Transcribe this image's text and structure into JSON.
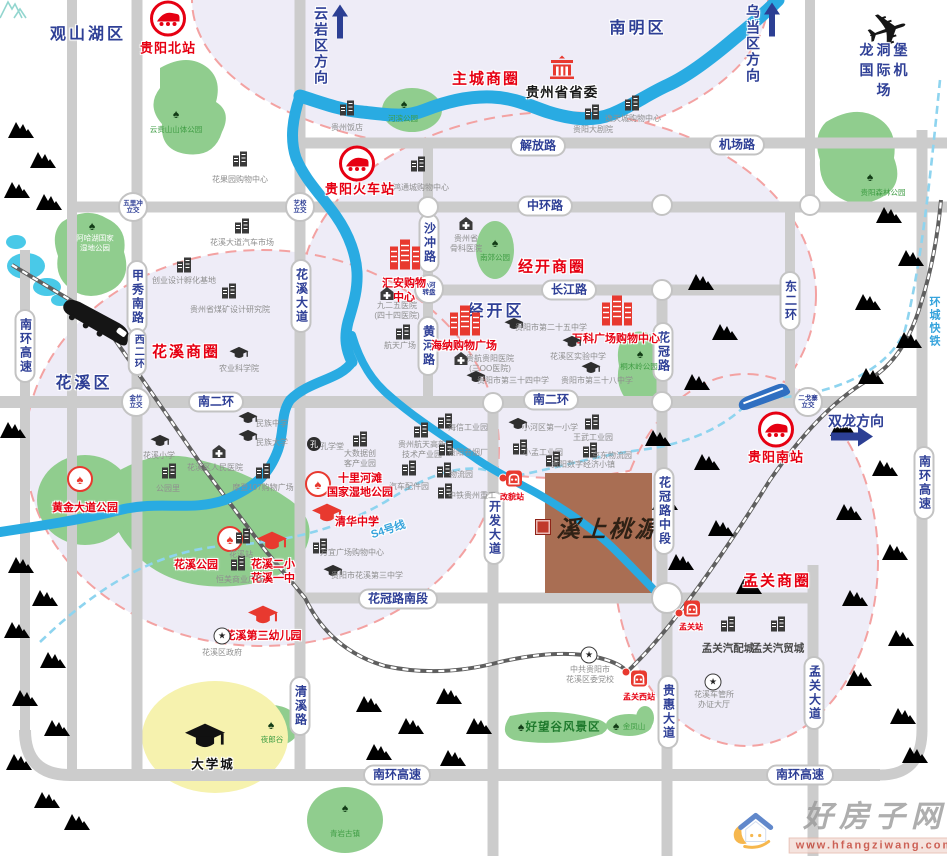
{
  "property": {
    "name": "溪上桃源"
  },
  "watermark": {
    "site": "好房子网",
    "url": "www.hfangziwang.com"
  },
  "districts": [
    {
      "t": "观山湖区",
      "x": 88,
      "y": 32
    },
    {
      "t": "南明区",
      "x": 638,
      "y": 26
    },
    {
      "t": "花溪区",
      "x": 84,
      "y": 381
    },
    {
      "t": "经开区",
      "x": 496,
      "y": 309
    }
  ],
  "directions": [
    {
      "t": "云岩区方向",
      "x": 321,
      "y": 46,
      "ax": 340,
      "ay": 24,
      "arrow": "up"
    },
    {
      "t": "乌当区方向",
      "x": 753,
      "y": 44,
      "ax": 772,
      "ay": 22,
      "arrow": "up"
    },
    {
      "t": "双龙方向",
      "x": 856,
      "y": 421,
      "ax": 852,
      "ay": 439,
      "arrow": "right"
    }
  ],
  "biz_labels": [
    {
      "t": "主城商圈",
      "x": 486,
      "y": 78
    },
    {
      "t": "经开商圈",
      "x": 552,
      "y": 266
    },
    {
      "t": "花溪商圈",
      "x": 186,
      "y": 351
    },
    {
      "t": "孟关商圈",
      "x": 777,
      "y": 580
    }
  ],
  "road_labels": [
    {
      "t": "解放路",
      "x": 538,
      "y": 146
    },
    {
      "t": "机场路",
      "x": 737,
      "y": 145
    },
    {
      "t": "中环路",
      "x": 545,
      "y": 206
    },
    {
      "t": "长江路",
      "x": 569,
      "y": 290
    },
    {
      "t": "南二环",
      "x": 216,
      "y": 402
    },
    {
      "t": "南二环",
      "x": 551,
      "y": 400
    },
    {
      "t": "花冠路南段",
      "x": 398,
      "y": 599
    },
    {
      "t": "南环高速",
      "x": 397,
      "y": 775
    },
    {
      "t": "南环高速",
      "x": 800,
      "y": 775
    },
    {
      "t": "甲秀南路",
      "x": 137,
      "y": 297,
      "v": 1
    },
    {
      "t": "西二环",
      "x": 137,
      "y": 352,
      "v": 1,
      "small": 1
    },
    {
      "t": "花溪大道",
      "x": 301,
      "y": 296,
      "v": 1
    },
    {
      "t": "沙冲路",
      "x": 429,
      "y": 243,
      "v": 1
    },
    {
      "t": "黄河路",
      "x": 428,
      "y": 346,
      "v": 1
    },
    {
      "t": "花冠路",
      "x": 663,
      "y": 352,
      "v": 1
    },
    {
      "t": "花冠路中段",
      "x": 664,
      "y": 511,
      "v": 1
    },
    {
      "t": "开发大道",
      "x": 494,
      "y": 528,
      "v": 1
    },
    {
      "t": "清溪路",
      "x": 300,
      "y": 706,
      "v": 1
    },
    {
      "t": "贵惠大道",
      "x": 668,
      "y": 712,
      "v": 1
    },
    {
      "t": "孟关大道",
      "x": 814,
      "y": 693,
      "v": 1
    },
    {
      "t": "东二环",
      "x": 790,
      "y": 301,
      "v": 1
    },
    {
      "t": "南环高速",
      "x": 25,
      "y": 346,
      "v": 1
    },
    {
      "t": "南环高速",
      "x": 924,
      "y": 483,
      "v": 1
    }
  ],
  "junctions": [
    {
      "t": "五里冲\n立交",
      "x": 133,
      "y": 207,
      "r": 13
    },
    {
      "t": "艺校\n立交",
      "x": 300,
      "y": 207,
      "r": 13
    },
    {
      "t": "小河\n转盘",
      "x": 429,
      "y": 289,
      "r": 13
    },
    {
      "t": "金竹\n立交",
      "x": 136,
      "y": 402,
      "r": 13
    },
    {
      "t": "二戈寨\n立交",
      "x": 808,
      "y": 402,
      "r": 13
    },
    {
      "t": "",
      "x": 428,
      "y": 207,
      "r": 9
    },
    {
      "t": "",
      "x": 662,
      "y": 205,
      "r": 9
    },
    {
      "t": "",
      "x": 810,
      "y": 205,
      "r": 9
    },
    {
      "t": "",
      "x": 662,
      "y": 290,
      "r": 9
    },
    {
      "t": "",
      "x": 493,
      "y": 403,
      "r": 9
    },
    {
      "t": "",
      "x": 662,
      "y": 402,
      "r": 9
    },
    {
      "t": "",
      "x": 667,
      "y": 598,
      "r": 14
    }
  ],
  "rail_text": [
    {
      "t": "S4号线",
      "x": 388,
      "y": 529,
      "rot": -18
    },
    {
      "t": "环城快铁",
      "x": 934,
      "y": 322,
      "v": 1
    }
  ],
  "big_stations": [
    {
      "t": "贵阳北站",
      "ix": 168,
      "iy": 21,
      "lx": 168,
      "ly": 47
    },
    {
      "t": "贵阳火车站",
      "ix": 357,
      "iy": 166,
      "lx": 360,
      "ly": 188
    },
    {
      "t": "贵阳南站",
      "ix": 776,
      "iy": 432,
      "lx": 776,
      "ly": 456
    }
  ],
  "small_stations": [
    {
      "t": "改貌站",
      "dx": 503,
      "dy": 478,
      "ix": 514,
      "iy": 481,
      "lx": 512,
      "ly": 497
    },
    {
      "t": "孟关站",
      "dx": 679,
      "dy": 613,
      "ix": 692,
      "iy": 611,
      "lx": 691,
      "ly": 627
    },
    {
      "t": "孟关西站",
      "dx": 626,
      "dy": 672,
      "ix": 639,
      "iy": 681,
      "lx": 639,
      "ly": 697
    }
  ],
  "gov": {
    "t": "贵州省省委",
    "ix": 562,
    "iy": 70,
    "lx": 562,
    "ly": 91
  },
  "malls": [
    {
      "t": "汇安购物\n中心",
      "ix": 405,
      "iy": 256,
      "lx": 404,
      "ly": 291
    },
    {
      "t": "海纳购物广场",
      "ix": 465,
      "iy": 322,
      "lx": 464,
      "ly": 346
    },
    {
      "t": "万科广场购物中心",
      "ix": 617,
      "iy": 312,
      "lx": 616,
      "ly": 339
    }
  ],
  "red_parks": [
    {
      "t": "十里河滩\n国家湿地公园",
      "ix": 318,
      "iy": 484,
      "lx": 360,
      "ly": 486
    },
    {
      "t": "花溪公园",
      "ix": 230,
      "iy": 539,
      "lx": 196,
      "ly": 565
    },
    {
      "t": "黄金大道公园",
      "ix": 80,
      "iy": 479,
      "lx": 85,
      "ly": 508
    }
  ],
  "red_schools": [
    {
      "t": "清华中学",
      "ix": 327,
      "iy": 515,
      "lx": 357,
      "ly": 522
    },
    {
      "t": "花溪二小\n花溪一中",
      "ix": 272,
      "iy": 543,
      "lx": 273,
      "ly": 572
    },
    {
      "t": "花溪第三幼儿园",
      "ix": 263,
      "iy": 617,
      "lx": 263,
      "ly": 636
    }
  ],
  "schools": [
    {
      "t": "贵阳市第二十五中学",
      "ix": 514,
      "iy": 326,
      "lx": 551,
      "ly": 328
    },
    {
      "t": "花溪区实验中学",
      "ix": 572,
      "iy": 344,
      "lx": 578,
      "ly": 357
    },
    {
      "t": "贵阳市第三十四中学",
      "ix": 476,
      "iy": 379,
      "lx": 513,
      "ly": 381
    },
    {
      "t": "贵阳市第三十八中学",
      "ix": 591,
      "iy": 370,
      "lx": 597,
      "ly": 381
    },
    {
      "t": "农业科学院",
      "ix": 239,
      "iy": 355,
      "lx": 239,
      "ly": 369
    },
    {
      "t": "民族中学",
      "ix": 248,
      "iy": 420,
      "lx": 272,
      "ly": 424
    },
    {
      "t": "民族大学",
      "ix": 248,
      "iy": 438,
      "lx": 272,
      "ly": 443
    },
    {
      "t": "花溪小学",
      "ix": 160,
      "iy": 443,
      "lx": 159,
      "ly": 456
    },
    {
      "t": "小河区第一小学",
      "ix": 518,
      "iy": 426,
      "lx": 550,
      "ly": 428
    },
    {
      "t": "贵阳市花溪第三中学",
      "ix": 333,
      "iy": 573,
      "lx": 367,
      "ly": 576
    }
  ],
  "hospitals": [
    {
      "t": "花溪区人民医院",
      "ix": 219,
      "iy": 454,
      "lx": 215,
      "ly": 468
    },
    {
      "t": "九二五医院\n(四十四医院)",
      "ix": 387,
      "iy": 296,
      "lx": 397,
      "ly": 311
    },
    {
      "t": "贵航贵阳医院\n(三OO医院)",
      "ix": 461,
      "iy": 361,
      "lx": 490,
      "ly": 364
    },
    {
      "t": "贵州省\n骨科医院",
      "ix": 466,
      "iy": 226,
      "lx": 466,
      "ly": 244
    }
  ],
  "buildings": [
    {
      "t": "花果园购物中心",
      "ix": 240,
      "iy": 161,
      "lx": 240,
      "ly": 180
    },
    {
      "t": "鸿通城购物中心",
      "ix": 418,
      "iy": 166,
      "lx": 421,
      "ly": 188
    },
    {
      "t": "贵州饭店",
      "ix": 347,
      "iy": 110,
      "lx": 347,
      "ly": 128
    },
    {
      "t": "贵阳大剧院",
      "ix": 592,
      "iy": 114,
      "lx": 593,
      "ly": 130
    },
    {
      "t": "逸天城购物中心",
      "ix": 632,
      "iy": 105,
      "lx": 633,
      "ly": 119
    },
    {
      "t": "花溪大道汽车市场",
      "ix": 242,
      "iy": 228,
      "lx": 242,
      "ly": 243
    },
    {
      "t": "创业设计孵化基地",
      "ix": 184,
      "iy": 267,
      "lx": 184,
      "ly": 281
    },
    {
      "t": "贵州省煤矿设计研究院",
      "ix": 229,
      "iy": 293,
      "lx": 230,
      "ly": 310
    },
    {
      "t": "航天广场",
      "ix": 403,
      "iy": 334,
      "lx": 400,
      "ly": 346
    },
    {
      "t": "摩登107购物广场",
      "ix": 263,
      "iy": 473,
      "lx": 263,
      "ly": 488
    },
    {
      "t": "公园里",
      "ix": 169,
      "iy": 473,
      "lx": 168,
      "ly": 489
    },
    {
      "t": "万宜广场购物中心",
      "ix": 320,
      "iy": 548,
      "lx": 352,
      "ly": 553
    },
    {
      "t": "恒美商业广场",
      "ix": 238,
      "iy": 565,
      "lx": 240,
      "ly": 580
    },
    {
      "t": "花溪站",
      "ix": 243,
      "iy": 538,
      "lx": 241,
      "ly": 555
    },
    {
      "t": "大数据创\n客产业园",
      "ix": 360,
      "iy": 441,
      "lx": 360,
      "ly": 459
    },
    {
      "t": "贵州航天高新\n技术产业园",
      "ix": 421,
      "iy": 432,
      "lx": 422,
      "ly": 450
    },
    {
      "t": "汽车配件园",
      "ix": 409,
      "iy": 470,
      "lx": 409,
      "ly": 487
    },
    {
      "t": "海信工业园",
      "ix": 445,
      "iy": 423,
      "lx": 468,
      "ly": 428
    },
    {
      "t": "贵阳卷烟厂",
      "ix": 446,
      "iy": 450,
      "lx": 468,
      "ly": 453
    },
    {
      "t": "物流园",
      "ix": 444,
      "iy": 472,
      "lx": 461,
      "ly": 475
    },
    {
      "t": "中铁贵州重工",
      "ix": 445,
      "iy": 493,
      "lx": 472,
      "ly": 496
    },
    {
      "t": "小孟工业园",
      "ix": 520,
      "iy": 449,
      "lx": 543,
      "ly": 453
    },
    {
      "t": "王武工业园",
      "ix": 592,
      "iy": 424,
      "lx": 593,
      "ly": 438
    },
    {
      "t": "贵阳数字经济小镇",
      "ix": 553,
      "iy": 461,
      "lx": 583,
      "ly": 465
    },
    {
      "t": "京东物流园",
      "ix": 590,
      "iy": 452,
      "lx": 612,
      "ly": 456
    },
    {
      "t": "孟关汽配城",
      "ix": 728,
      "iy": 626,
      "lx": 728,
      "ly": 649,
      "big": 1
    },
    {
      "t": "孟关汽贸城",
      "ix": 778,
      "iy": 626,
      "lx": 778,
      "ly": 649,
      "big": 1
    },
    {
      "t": "孔学堂",
      "ix": 314,
      "iy": 444,
      "lx": 332,
      "ly": 447,
      "kind": "circle"
    }
  ],
  "stars": [
    {
      "t": "花溪区政府",
      "ix": 222,
      "iy": 636,
      "lx": 222,
      "ly": 653
    },
    {
      "t": "中共贵阳市\n花溪区委党校",
      "ix": 589,
      "iy": 655,
      "lx": 590,
      "ly": 675
    },
    {
      "t": "花溪车管所\n办证大厅",
      "ix": 713,
      "iy": 682,
      "lx": 714,
      "ly": 700
    }
  ],
  "park_labels": [
    {
      "t": "云贵山山体公园",
      "tx": 176,
      "ty": 114,
      "lx": 176,
      "ly": 130
    },
    {
      "t": "河滨公园",
      "tx": 404,
      "ty": 104,
      "lx": 403,
      "ly": 119
    },
    {
      "t": "贵阳森林公园",
      "tx": 870,
      "ty": 177,
      "lx": 883,
      "ly": 193
    },
    {
      "t": "阿哈湖国家\n湿地公园",
      "tx": 92,
      "ty": 226,
      "lx": 95,
      "ly": 243,
      "white": 1
    },
    {
      "t": "南郊公园",
      "tx": 495,
      "ty": 243,
      "lx": 495,
      "ly": 258
    },
    {
      "t": "桐木岭公园",
      "tx": 640,
      "ty": 354,
      "lx": 639,
      "ly": 367
    },
    {
      "t": "夜郎谷",
      "tx": 271,
      "ty": 725,
      "lx": 272,
      "ly": 740
    },
    {
      "t": "好望谷风景区",
      "tx": 521,
      "ty": 727,
      "lx": 563,
      "ly": 728,
      "big": 1
    },
    {
      "t": "金凤山",
      "tx": 616,
      "ty": 726,
      "lx": 634,
      "ly": 727
    },
    {
      "t": "青岩古镇",
      "tx": 345,
      "ty": 808,
      "lx": 345,
      "ly": 834
    }
  ],
  "university": {
    "t": "大学城",
    "ix": 205,
    "iy": 738,
    "lx": 213,
    "ly": 763
  },
  "airport": {
    "t": "龙洞堡国际机场",
    "ix": 888,
    "iy": 32,
    "lx": 885,
    "ly": 70
  }
}
